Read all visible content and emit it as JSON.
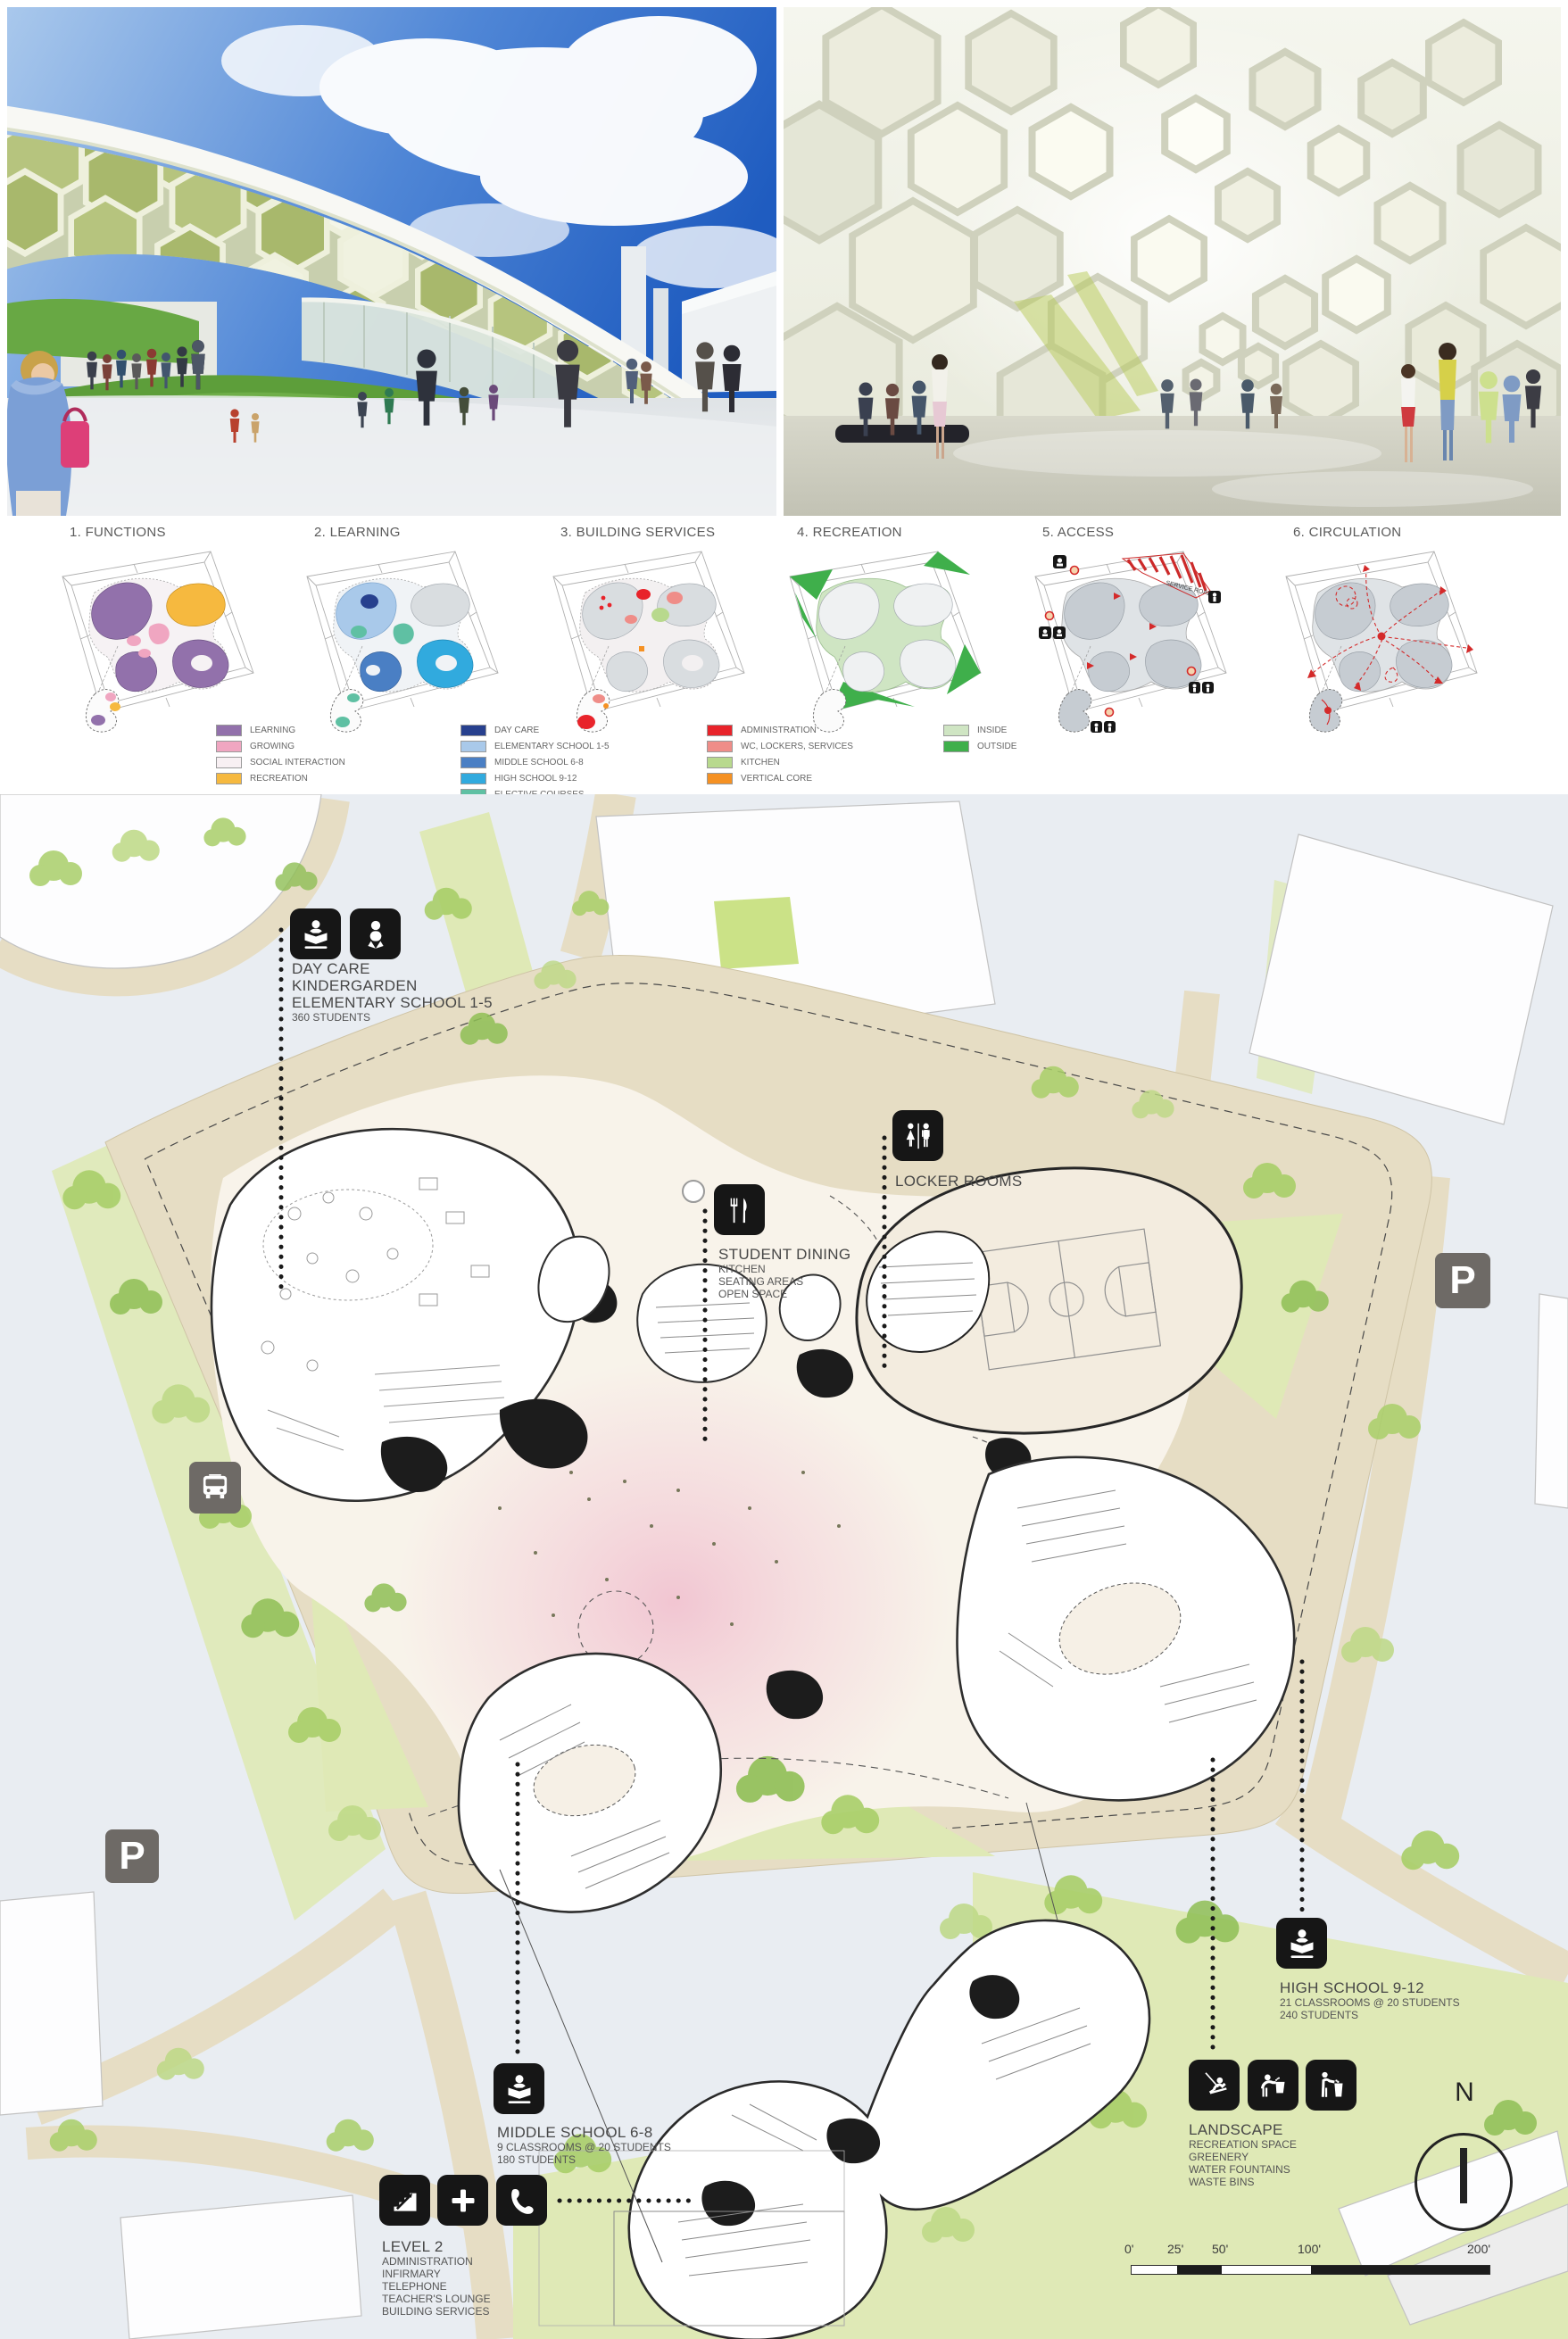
{
  "diagrams": {
    "items": [
      {
        "title": "1. FUNCTIONS",
        "legend": [
          {
            "label": "LEARNING",
            "color": "#9271ab"
          },
          {
            "label": "GROWING",
            "color": "#f0a6c1"
          },
          {
            "label": "SOCIAL INTERACTION",
            "color": "#f8f0f3"
          },
          {
            "label": "RECREATION",
            "color": "#f6b93f"
          }
        ]
      },
      {
        "title": "2. LEARNING",
        "legend": [
          {
            "label": "DAY CARE",
            "color": "#27408e"
          },
          {
            "label": "ELEMENTARY SCHOOL 1-5",
            "color": "#a9c9ea"
          },
          {
            "label": "MIDDLE SCHOOL 6-8",
            "color": "#4a7fc4"
          },
          {
            "label": "HIGH SCHOOL 9-12",
            "color": "#31aade"
          },
          {
            "label": "ELECTIVE COURSES",
            "color": "#5fc0a3"
          }
        ]
      },
      {
        "title": "3. BUILDING SERVICES",
        "legend": [
          {
            "label": "ADMINISTRATION",
            "color": "#e8232a"
          },
          {
            "label": "WC, LOCKERS, SERVICES",
            "color": "#ef8d88"
          },
          {
            "label": "KITCHEN",
            "color": "#b8d98d"
          },
          {
            "label": "VERTICAL CORE",
            "color": "#f59123"
          }
        ]
      },
      {
        "title": "4. RECREATION",
        "legend": [
          {
            "label": "INSIDE",
            "color": "#cfe5c3"
          },
          {
            "label": "OUTSIDE",
            "color": "#3faf4b"
          }
        ]
      },
      {
        "title": "5. ACCESS",
        "legend": [],
        "service_road_label": "SERVICE ROAD"
      },
      {
        "title": "6. CIRCULATION",
        "legend": []
      }
    ]
  },
  "siteplan": {
    "labels": {
      "day_care": {
        "icons": [
          "reader-icon",
          "baby-icon"
        ],
        "title_lines": [
          "DAY CARE",
          "KINDERGARDEN",
          "ELEMENTARY SCHOOL 1-5"
        ],
        "sub_lines": [
          "360 STUDENTS"
        ]
      },
      "locker_rooms": {
        "icons": [
          "wc-icon"
        ],
        "title_lines": [
          "LOCKER ROOMS"
        ],
        "sub_lines": []
      },
      "student_dining": {
        "icons": [
          "dining-icon"
        ],
        "title_lines": [
          "STUDENT DINING"
        ],
        "sub_lines": [
          "KITCHEN",
          "SEATING AREAS",
          "OPEN SPACE"
        ]
      },
      "high_school": {
        "icons": [
          "reader-icon"
        ],
        "title_lines": [
          "HIGH SCHOOL 9-12"
        ],
        "sub_lines": [
          "21 CLASSROOMS @ 20 STUDENTS",
          "240 STUDENTS"
        ]
      },
      "middle_school": {
        "icons": [
          "reader-icon"
        ],
        "title_lines": [
          "MIDDLE SCHOOL 6-8"
        ],
        "sub_lines": [
          "9 CLASSROOMS @ 20 STUDENTS",
          "180 STUDENTS"
        ]
      },
      "landscape": {
        "icons": [
          "swing-icon",
          "fountain-icon",
          "waste-icon"
        ],
        "title_lines": [
          "LANDSCAPE"
        ],
        "sub_lines": [
          "RECREATION SPACE",
          "GREENERY",
          "WATER FOUNTAINS",
          "WASTE BINS"
        ]
      },
      "level_2": {
        "icons": [
          "stairs-icon",
          "infirmary-icon",
          "telephone-icon"
        ],
        "title_lines": [
          "LEVEL 2"
        ],
        "sub_lines": [
          "ADMINISTRATION",
          "INFIRMARY",
          "TELEPHONE",
          "TEACHER'S LOUNGE",
          "BUILDING SERVICES"
        ]
      }
    },
    "markers": {
      "parking_label": "P",
      "bus_stop": "bus-icon",
      "north_label": "N"
    },
    "scale_bar": {
      "ticks": [
        "0'",
        "25'",
        "50'",
        "100'",
        "200'"
      ]
    }
  },
  "palette": {
    "site_beige": "#e6ddc4",
    "plan_bg": "#e9edf2",
    "field_green": "#dfe9b6",
    "tree_green": "#a9cf69",
    "court_cream": "#f3ecdf",
    "center_pink": "#eca0be",
    "icon_black": "#161616",
    "icon_gray": "#6e6a66",
    "wall_dark": "#2e2e2e"
  }
}
